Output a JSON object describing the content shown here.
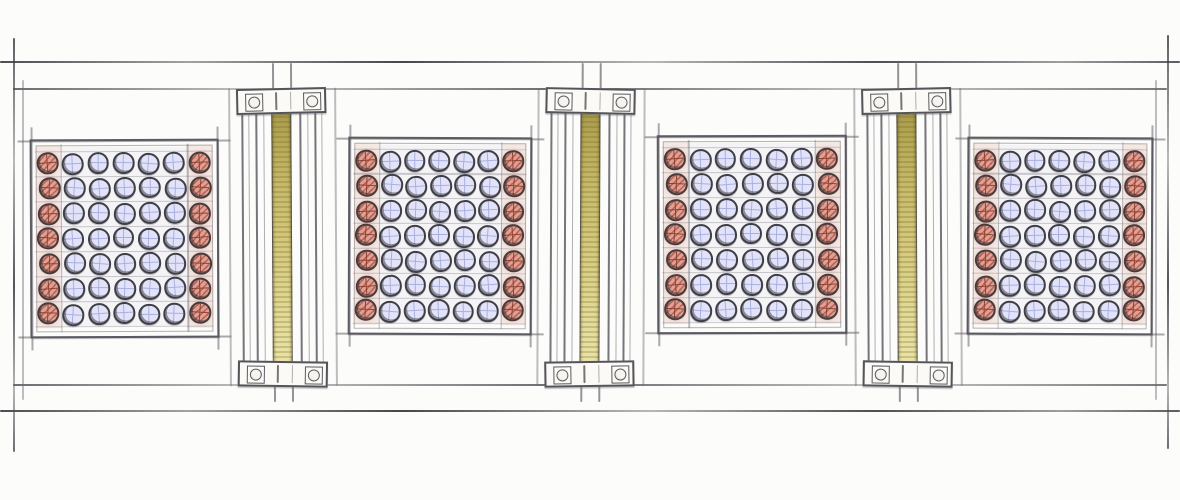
{
  "scene": {
    "type": "architectural-elevation-sketch",
    "medium": "pencil-and-colored-pencil",
    "background": "#fcfcfa"
  },
  "palette": {
    "paper": "#fcfcfa",
    "ring": "#3f3e45",
    "red_fill": "#e0a094",
    "red_cross": "#8d4434",
    "blue_fill": "#e2e3f8",
    "blue_cross": "#a9b0e0",
    "strip_dark": "#a2954a",
    "strip_light": "#ece5ad",
    "plate_fill": "#fbfaf6"
  },
  "layout": {
    "width": 1180,
    "height": 500,
    "rails": {
      "top_y": 61,
      "head_y": 88,
      "sill_y": 384,
      "bottom_y": 410,
      "left_x": 13,
      "right_x": 1167,
      "left_inner_x": 22,
      "right_inner_x": 1155,
      "edge_top": 38,
      "edge_bottom": 452,
      "inner_top": 80,
      "inner_bottom": 400
    },
    "panel_grid": {
      "rows": 7,
      "cols": 7,
      "dia": 21.5,
      "pad_x": 4,
      "pad_y": 9.5,
      "red_columns": [
        0,
        6
      ]
    },
    "column_geom": {
      "half_bay": 53,
      "shaft_offsets": [
        -40,
        -33,
        -26,
        -18,
        18,
        26,
        33,
        40
      ],
      "strip_half": 10,
      "band_half": 45,
      "band_h": 26,
      "band_top": 88,
      "band_bottom_top": 361,
      "shaft_top": 96,
      "shaft_bottom": 381,
      "strip_top": 100,
      "strip_bottom": 378,
      "stub_half": 9,
      "stub_top": 63,
      "stub_bottom": 402,
      "bay_top": 88,
      "bay_bottom": 386
    }
  },
  "panels": [
    {
      "name": "panel-1",
      "x": 30,
      "y": 139,
      "w": 189,
      "h": 199,
      "tilt": -0.25
    },
    {
      "name": "panel-2",
      "x": 348,
      "y": 137,
      "w": 184,
      "h": 198,
      "tilt": 0.2
    },
    {
      "name": "panel-3",
      "x": 657,
      "y": 135,
      "w": 190,
      "h": 199,
      "tilt": -0.15
    },
    {
      "name": "panel-4",
      "x": 967,
      "y": 137,
      "w": 186,
      "h": 198,
      "tilt": 0.25
    }
  ],
  "columns": [
    {
      "name": "column-1",
      "cx": 282,
      "tilt": -0.35
    },
    {
      "name": "column-2",
      "cx": 590,
      "tilt": 0.25
    },
    {
      "name": "column-3",
      "cx": 907,
      "tilt": -0.3
    }
  ]
}
